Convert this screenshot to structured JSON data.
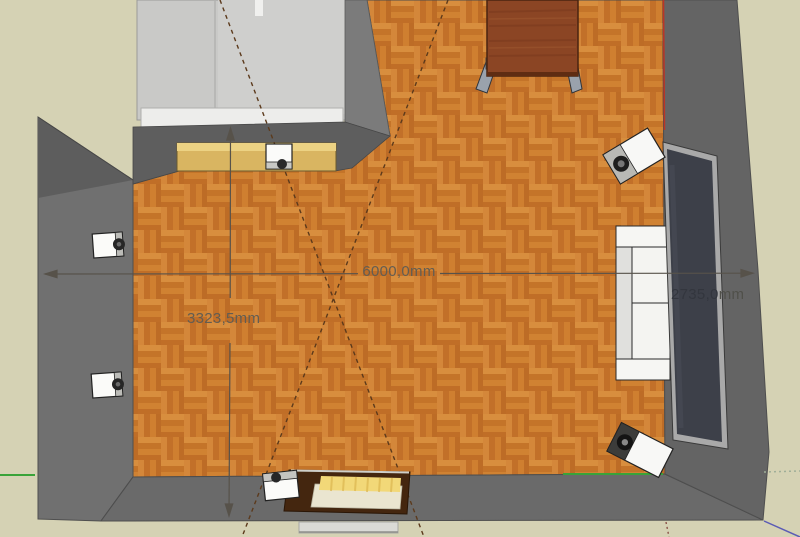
{
  "app": {
    "viewport": "3d-room-model-top-view"
  },
  "dimensions": {
    "width_label": "6000,0mm",
    "height_label": "3323,5mm",
    "right_partial_digits": "2735,0",
    "right_partial_unit": "mm"
  },
  "colors": {
    "floor_parquet": "#cc7b2d",
    "wall_gray": "#6c6c6c",
    "outside_beige": "#d5d2b4",
    "bay_light_gray": "#c9c9c7",
    "shelf_wood": "#d9b561",
    "tv_screen": "#3d4049",
    "sofa_white": "#f4f4f1",
    "bed_frame_brown": "#44260f",
    "bed_pillow_yellow": "#f2d878",
    "dimension_line": "#57524a",
    "construction_dash": "#5c3a1c",
    "axis_red": "#bb3526",
    "axis_green": "#39a339",
    "axis_blue": "#5b5bb5"
  }
}
